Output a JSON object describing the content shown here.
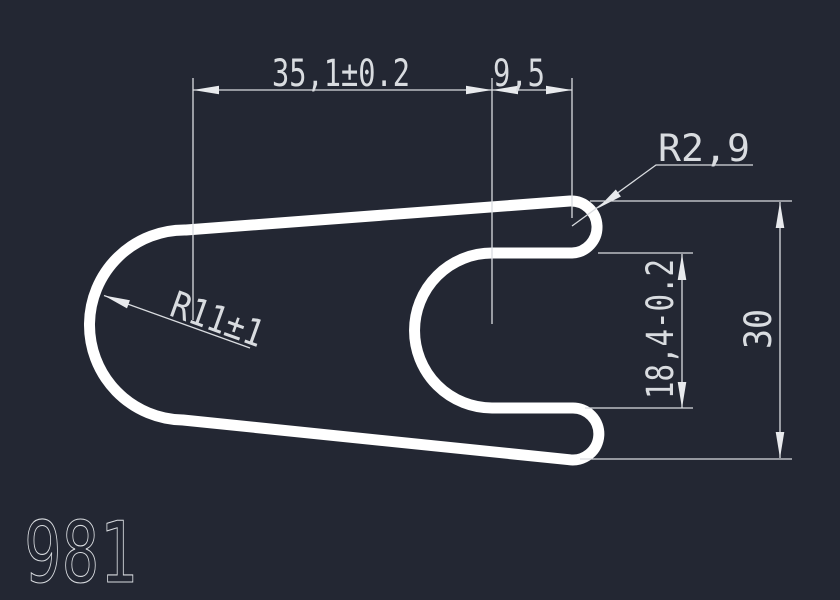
{
  "app": {
    "background_color": "#232733",
    "outline_color": "#ffffff",
    "dimension_color": "#d9dce0"
  },
  "drawing": {
    "number": "981",
    "dimensions": {
      "width_total": "35,1±0.2",
      "tip_offset": "9,5",
      "tip_radius": "R2,9",
      "nose_radius": "R11±1",
      "slot_height": "18,4-0.2",
      "overall_height": "30"
    }
  }
}
